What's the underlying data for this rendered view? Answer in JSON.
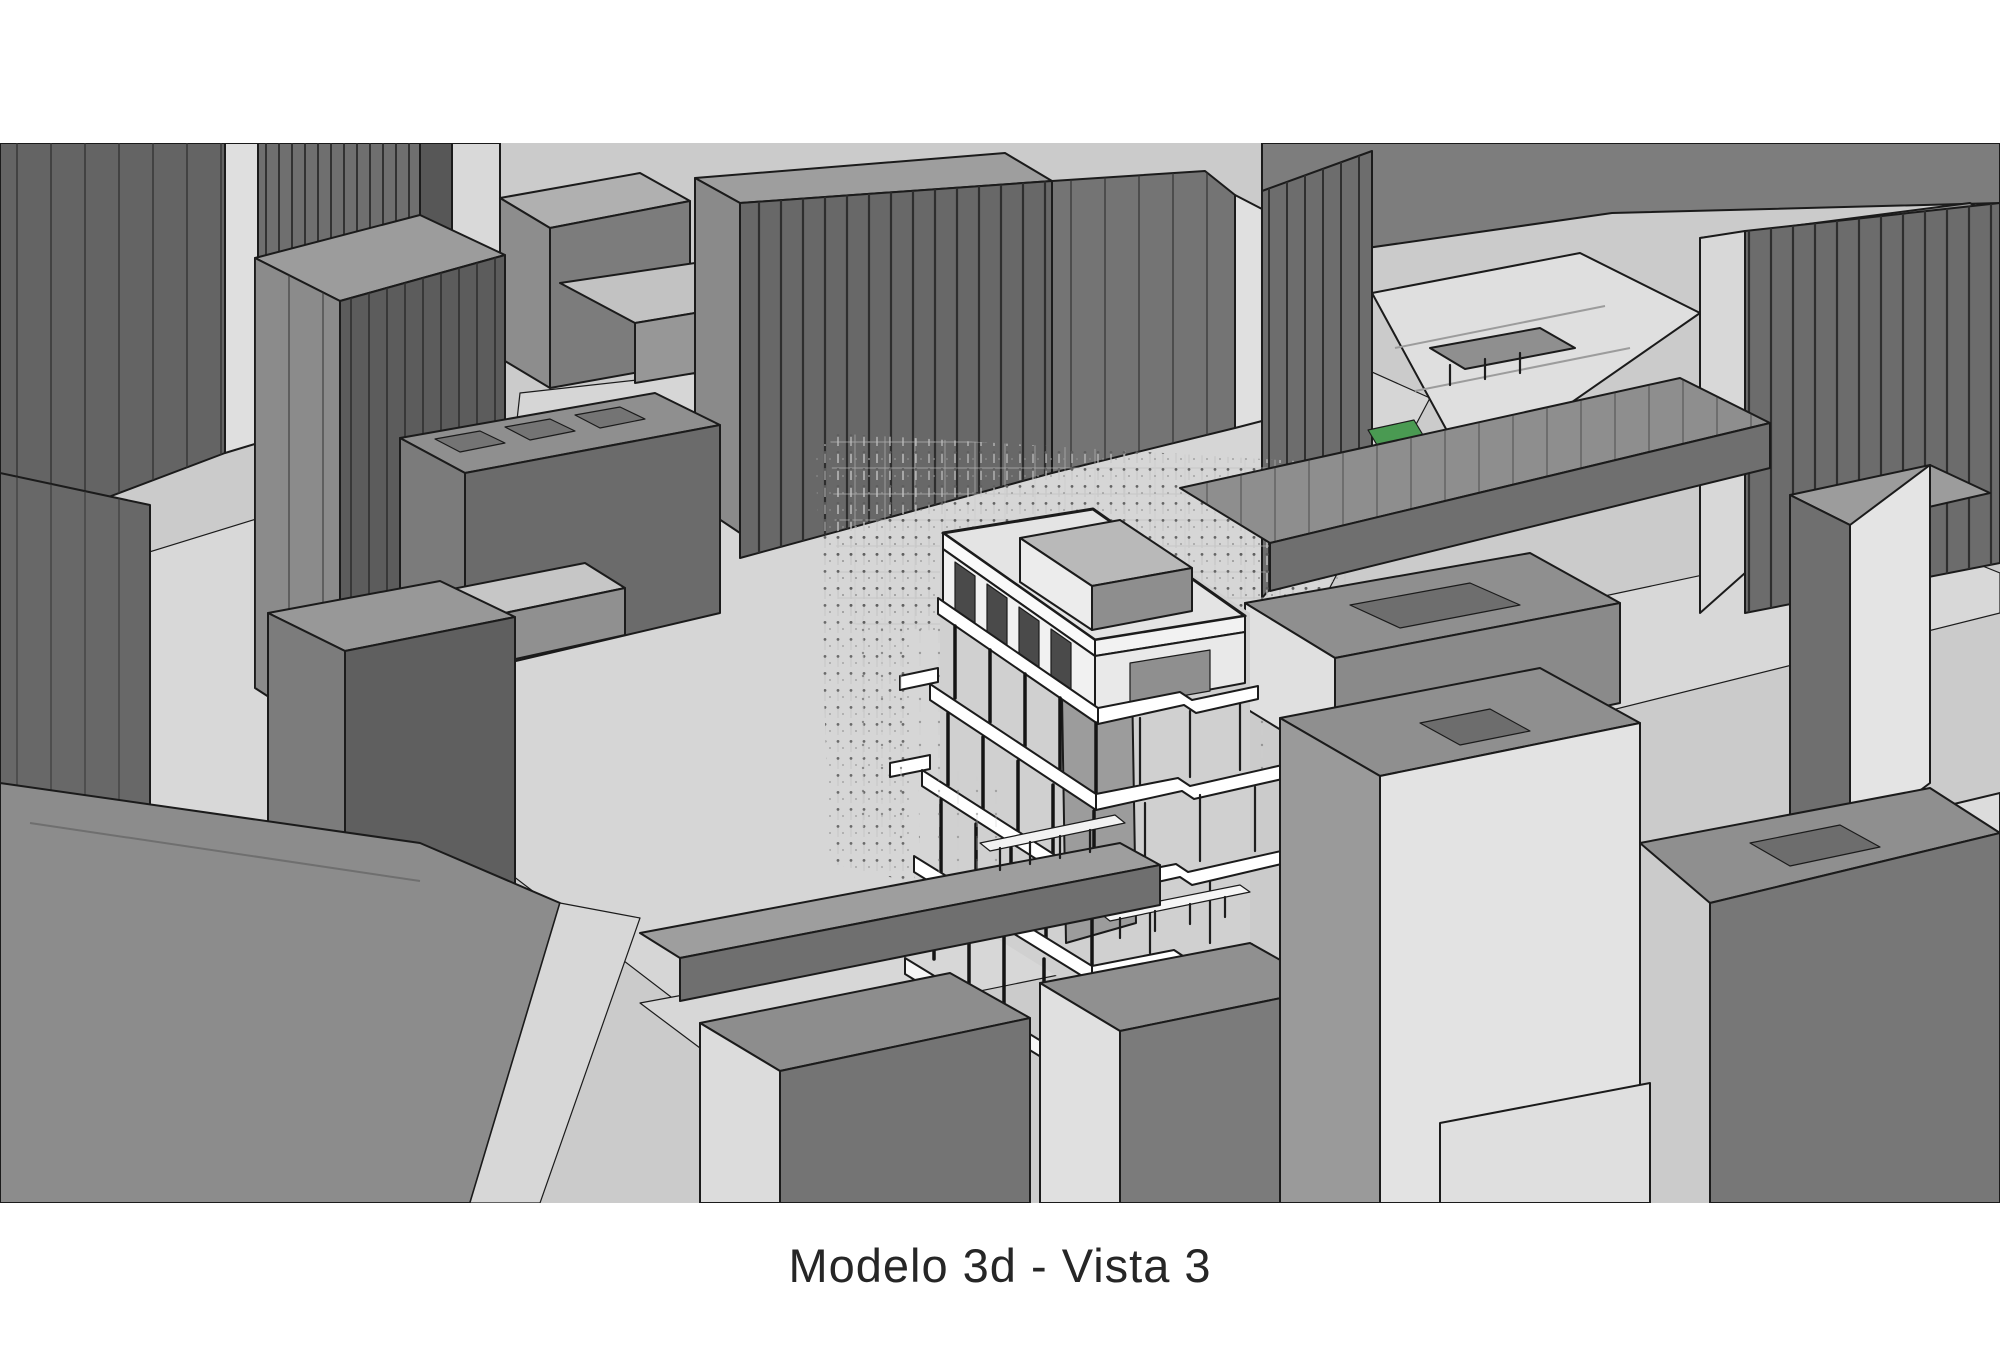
{
  "figure": {
    "caption": "Modelo 3d - Vista 3",
    "scene": "monochrome 3d massing model of a dense city block, aerial perspective view",
    "highlight": "central white multi-storey open concrete-frame building surrounded by a cloud of survey point markers",
    "palette": {
      "page_background": "#ffffff",
      "ground": "#cbcbcb",
      "street": "#d8d8d8",
      "roof_gray": "#8f8f8f",
      "facade_dark": "#696969",
      "facade_light": "#e3e3e3",
      "edge_line": "#1b1b1b",
      "highlight_white": "#ffffff",
      "marker_gray": "#9a9a9a",
      "vegetation_green": "#4a9a52"
    }
  }
}
